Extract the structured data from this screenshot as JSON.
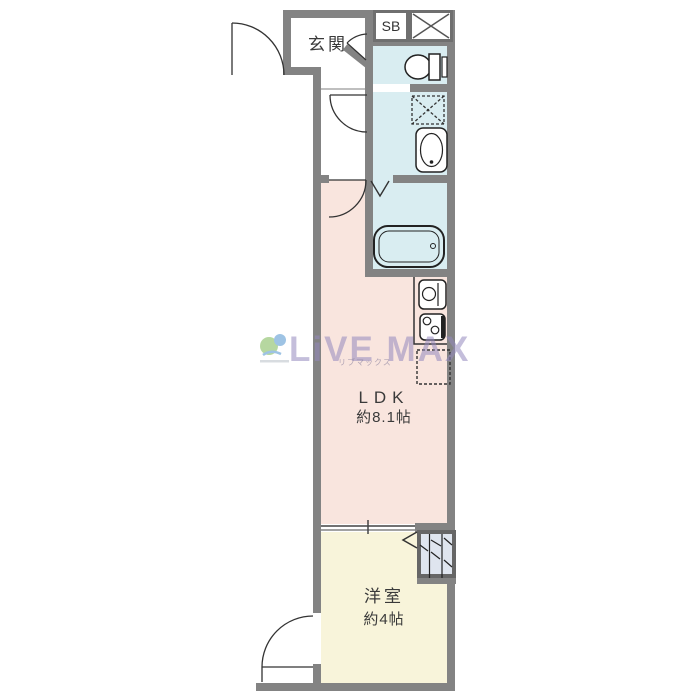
{
  "colors": {
    "wall": "#838383",
    "wet": "#d9edf1",
    "ldk": "#f9e5de",
    "western": "#f8f4da",
    "closet": "#dfe5ef",
    "line": "#333333",
    "wm": "#9488be"
  },
  "labels": {
    "entrance": "玄関",
    "shoe_box": "SB",
    "ldk": "LDK",
    "ldk_size": "約8.1帖",
    "western_room": "洋室",
    "western_room_size": "約4帖"
  },
  "watermark": {
    "brand": "LiVE MAX",
    "subtext": "リブマックス"
  },
  "fixtures": [
    "toilet-icon",
    "washing-machine-space-icon",
    "washbasin-icon",
    "bathtub-icon",
    "kitchen-sink-icon",
    "stove-icon",
    "refrigerator-space-icon",
    "closet-hangers-icon",
    "pipe-space-cross-icon"
  ]
}
